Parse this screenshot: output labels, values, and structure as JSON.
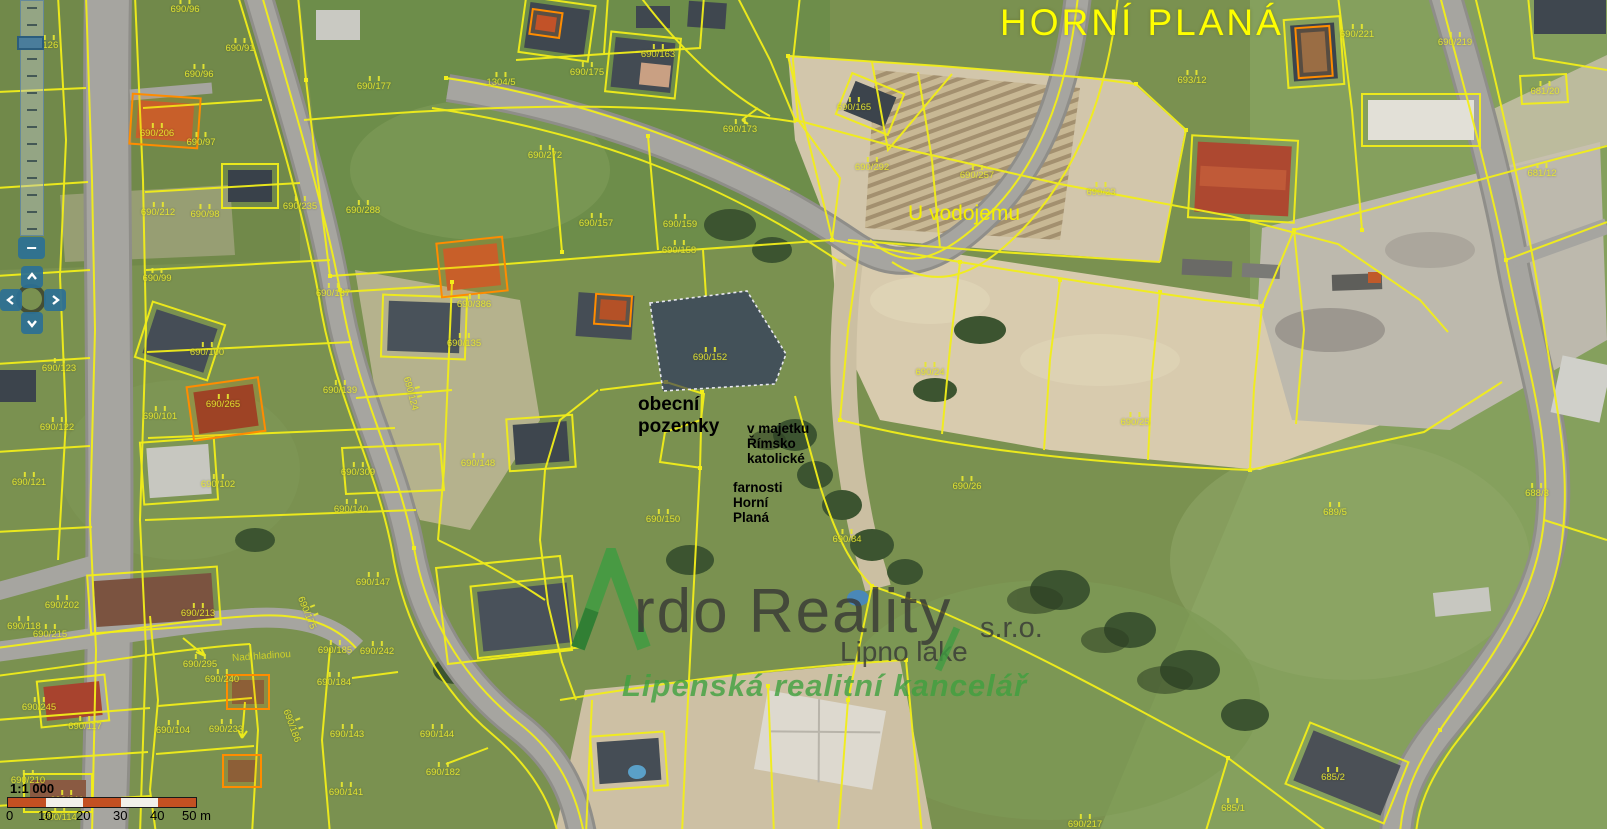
{
  "title": {
    "town": "HORNÍ PLANÁ",
    "area": "U vodojemu",
    "street": "Nad hladinou"
  },
  "annotations": {
    "municipal": "obecní\npozemky",
    "church_owner": "v majetku\nŘímsko\nkatolické",
    "church_owner2": "farnosti\nHorní\nPlaná"
  },
  "highlight": {
    "fill": "#1b2260",
    "border": "#e8e8f0"
  },
  "watermark": {
    "brand_initial": "A",
    "brand_rest": "rdo Reality",
    "company_suffix": "s.r.o.",
    "location": "Lipno lake",
    "tagline": "Lipenská realitní kancelář",
    "logo_green": "#3f9b41",
    "text_grey": "#343434"
  },
  "scalebar": {
    "ratio": "1:1 000",
    "ticks": [
      "0",
      "10",
      "20",
      "30",
      "40",
      "50 m"
    ],
    "bar_red": "#c35022",
    "bar_white": "#f2f0ea"
  },
  "controls": {
    "zoom_out": "−",
    "teal": "#2c7095"
  },
  "colors": {
    "parcel_line": "#f2ee1a",
    "parcel_text": "#e8e830",
    "orange_line": "#ff8c00"
  },
  "parcels": [
    {
      "t": "690/96",
      "x": 185,
      "y": 7
    },
    {
      "t": "690/91",
      "x": 240,
      "y": 46
    },
    {
      "t": "690/96",
      "x": 199,
      "y": 72
    },
    {
      "t": "690/177",
      "x": 374,
      "y": 84
    },
    {
      "t": "1304/5",
      "x": 501,
      "y": 80
    },
    {
      "t": "690/206",
      "x": 157,
      "y": 131
    },
    {
      "t": "690/97",
      "x": 201,
      "y": 140
    },
    {
      "t": "690/175",
      "x": 587,
      "y": 70
    },
    {
      "t": "690/163",
      "x": 658,
      "y": 52
    },
    {
      "t": "690/173",
      "x": 740,
      "y": 127
    },
    {
      "t": "690/272",
      "x": 545,
      "y": 153
    },
    {
      "t": "690/212",
      "x": 158,
      "y": 210
    },
    {
      "t": "690/98",
      "x": 205,
      "y": 212
    },
    {
      "t": "690/235",
      "x": 300,
      "y": 204
    },
    {
      "t": "690/288",
      "x": 363,
      "y": 208
    },
    {
      "t": "690/157",
      "x": 596,
      "y": 221
    },
    {
      "t": "690/159",
      "x": 680,
      "y": 222
    },
    {
      "t": "690/158",
      "x": 679,
      "y": 248
    },
    {
      "t": "690/165",
      "x": 854,
      "y": 105
    },
    {
      "t": "690/292",
      "x": 872,
      "y": 165
    },
    {
      "t": "690/257",
      "x": 977,
      "y": 173
    },
    {
      "t": "690/23",
      "x": 1101,
      "y": 190
    },
    {
      "t": "693/12",
      "x": 1192,
      "y": 78
    },
    {
      "t": "690/221",
      "x": 1357,
      "y": 32
    },
    {
      "t": "690/219",
      "x": 1455,
      "y": 40
    },
    {
      "t": "681/20",
      "x": 1545,
      "y": 89
    },
    {
      "t": "681/12",
      "x": 1542,
      "y": 171
    },
    {
      "t": "/126",
      "x": 49,
      "y": 43
    },
    {
      "t": "690/99",
      "x": 157,
      "y": 276
    },
    {
      "t": "690/137",
      "x": 333,
      "y": 291
    },
    {
      "t": "690/386",
      "x": 474,
      "y": 302
    },
    {
      "t": "690/135",
      "x": 464,
      "y": 341
    },
    {
      "t": "690/100",
      "x": 207,
      "y": 350
    },
    {
      "t": "690/139",
      "x": 340,
      "y": 388
    },
    {
      "t": "690/265",
      "x": 223,
      "y": 402
    },
    {
      "t": "690/101",
      "x": 160,
      "y": 414
    },
    {
      "t": "690/123",
      "x": 59,
      "y": 366
    },
    {
      "t": "690/122",
      "x": 57,
      "y": 425
    },
    {
      "t": "690/148",
      "x": 478,
      "y": 461
    },
    {
      "t": "690/309",
      "x": 358,
      "y": 470
    },
    {
      "t": "690/121",
      "x": 29,
      "y": 480
    },
    {
      "t": "690/102",
      "x": 218,
      "y": 482
    },
    {
      "t": "690/140",
      "x": 351,
      "y": 507
    },
    {
      "t": "690/124",
      "x": 413,
      "y": 393,
      "r": 75
    },
    {
      "t": "690/150",
      "x": 663,
      "y": 517
    },
    {
      "t": "690/152",
      "x": 710,
      "y": 355
    },
    {
      "t": "690/24",
      "x": 930,
      "y": 370
    },
    {
      "t": "690/25",
      "x": 1135,
      "y": 420
    },
    {
      "t": "690/26",
      "x": 967,
      "y": 484
    },
    {
      "t": "690/84",
      "x": 847,
      "y": 537
    },
    {
      "t": "690/147",
      "x": 373,
      "y": 580
    },
    {
      "t": "690/202",
      "x": 62,
      "y": 603
    },
    {
      "t": "690/213",
      "x": 198,
      "y": 611
    },
    {
      "t": "690/175",
      "x": 309,
      "y": 612,
      "r": 68
    },
    {
      "t": "690/118",
      "x": 24,
      "y": 624
    },
    {
      "t": "690/215",
      "x": 50,
      "y": 632
    },
    {
      "t": "690/185",
      "x": 335,
      "y": 648
    },
    {
      "t": "690/242",
      "x": 377,
      "y": 649
    },
    {
      "t": "690/295",
      "x": 200,
      "y": 662
    },
    {
      "t": "690/240",
      "x": 222,
      "y": 677
    },
    {
      "t": "690/184",
      "x": 334,
      "y": 680
    },
    {
      "t": "690/245",
      "x": 39,
      "y": 705
    },
    {
      "t": "690/117",
      "x": 85,
      "y": 724
    },
    {
      "t": "690/104",
      "x": 173,
      "y": 728
    },
    {
      "t": "690/233",
      "x": 226,
      "y": 727
    },
    {
      "t": "690/186",
      "x": 294,
      "y": 725,
      "r": 70
    },
    {
      "t": "690/143",
      "x": 347,
      "y": 732
    },
    {
      "t": "690/144",
      "x": 437,
      "y": 732
    },
    {
      "t": "690/182",
      "x": 443,
      "y": 770
    },
    {
      "t": "690/210",
      "x": 28,
      "y": 778
    },
    {
      "t": "690/211",
      "x": 67,
      "y": 798
    },
    {
      "t": "690/141",
      "x": 346,
      "y": 790
    },
    {
      "t": "690/114",
      "x": 60,
      "y": 815
    },
    {
      "t": "689/5",
      "x": 1335,
      "y": 510
    },
    {
      "t": "688/3",
      "x": 1537,
      "y": 491
    },
    {
      "t": "685/2",
      "x": 1333,
      "y": 775
    },
    {
      "t": "685/1",
      "x": 1233,
      "y": 806
    },
    {
      "t": "690/217",
      "x": 1085,
      "y": 822
    }
  ]
}
